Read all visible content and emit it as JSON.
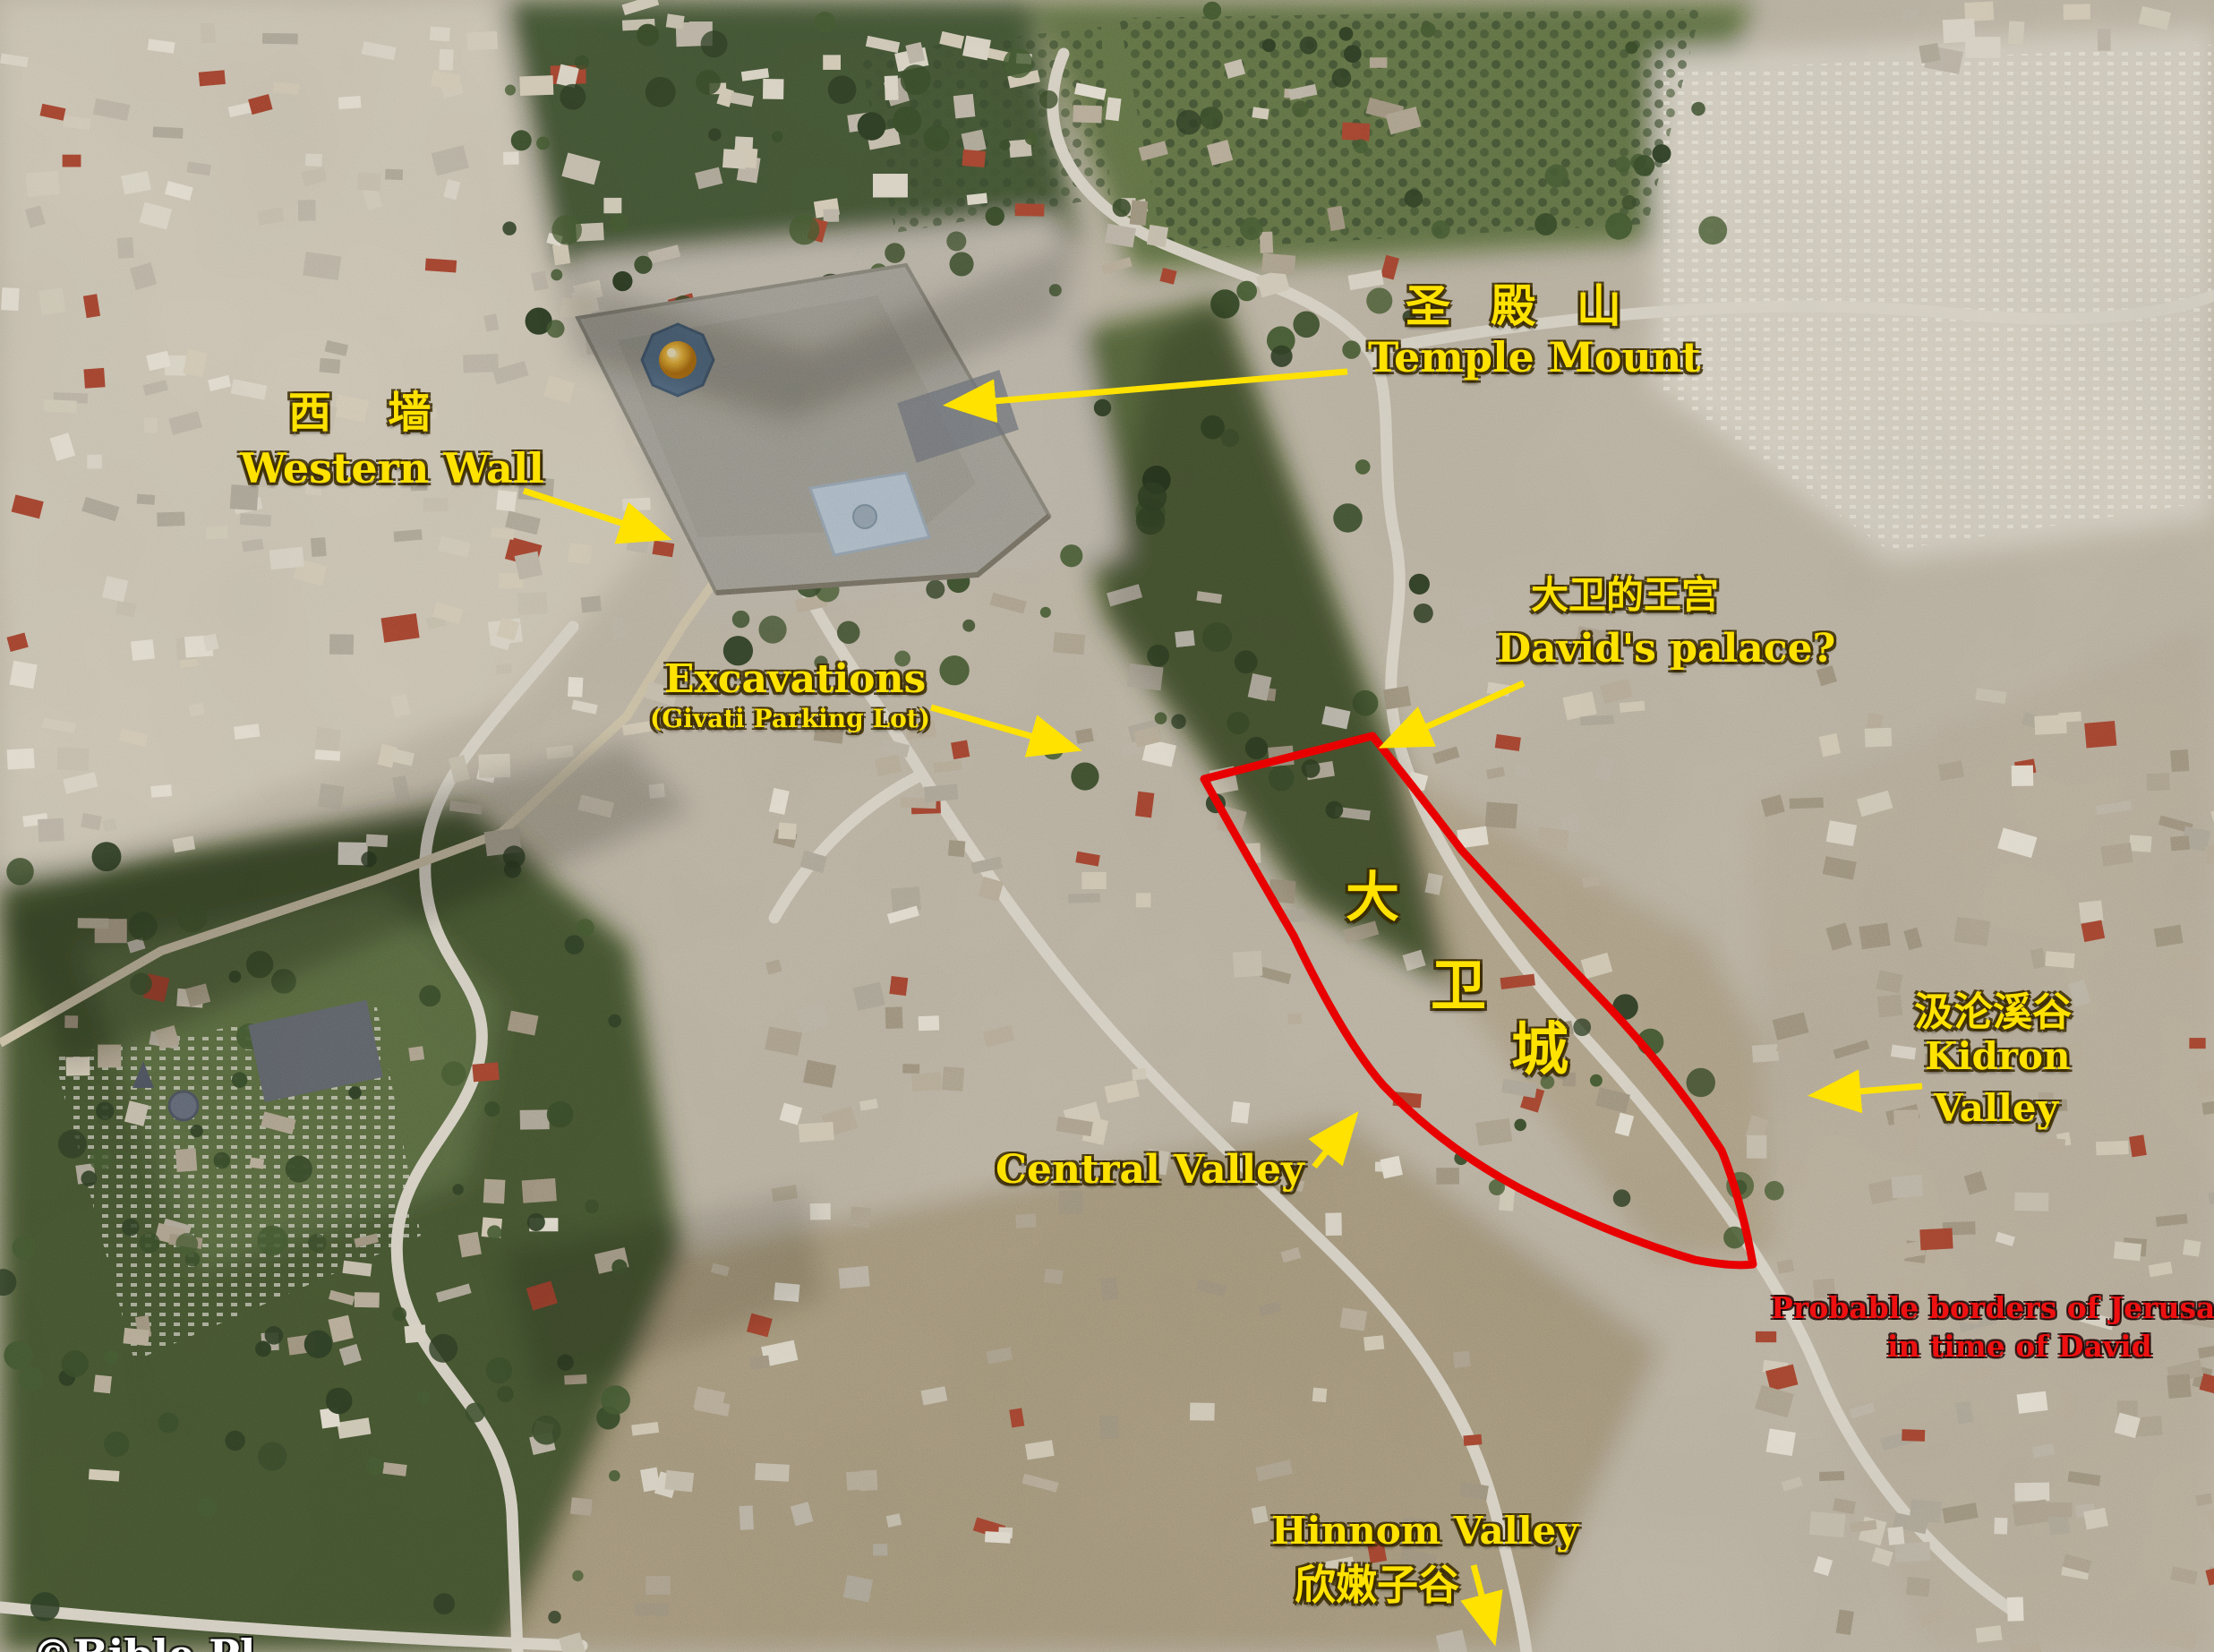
{
  "colors": {
    "label_yellow": "#ffe200",
    "label_red": "#ee1111",
    "border_red": "#e80000",
    "watermark_white": "#ffffff"
  },
  "annotations": {
    "temple_mount": {
      "zh": "圣 殿 山",
      "en": "Temple Mount"
    },
    "western_wall": {
      "zh": "西  墙",
      "en": "Western Wall"
    },
    "excavations": {
      "title": "Excavations",
      "subtitle": "(Givati Parking Lot)"
    },
    "davids_palace": {
      "zh": "大卫的王宫",
      "en": "David's palace?"
    },
    "city_of_david": {
      "zh_char_1": "大",
      "zh_char_2": "卫",
      "zh_char_3": "城"
    },
    "kidron_valley": {
      "zh": "汲沦溪谷",
      "en_line1": "Kidron",
      "en_line2": "Valley"
    },
    "central_valley": {
      "en": "Central Valley"
    },
    "hinnom_valley": {
      "en": "Hinnom Valley",
      "zh": "欣嫩子谷"
    },
    "borders_note": {
      "line1": "Probable borders of Jerusalem",
      "line2": "in time of David"
    },
    "watermark": {
      "text": "©Bible Pl"
    }
  }
}
